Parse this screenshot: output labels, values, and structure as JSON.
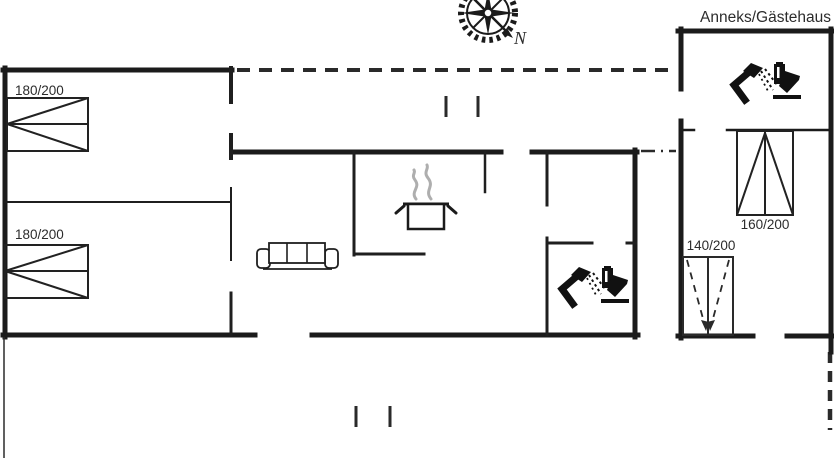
{
  "plan": {
    "annex_title": "Anneks/Gästehaus",
    "compass": {
      "label": "N"
    },
    "labels": {
      "bed_master": "180/200",
      "bed_second": "180/200",
      "bed_annex": "160/200",
      "bed_annex_extra": "140/200"
    },
    "colors": {
      "wall": "#1b1b1b",
      "text": "#2c2c2c",
      "steam": "#aeaeae",
      "background": "#ffffff"
    }
  }
}
